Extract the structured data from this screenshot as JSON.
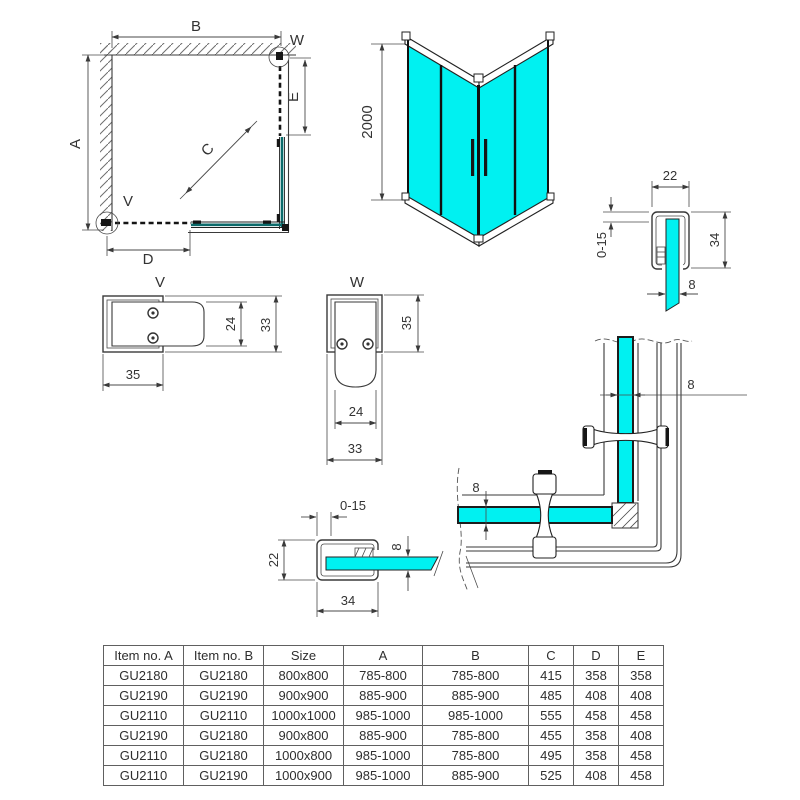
{
  "colors": {
    "glass": "#00f1f1",
    "glass_dark": "#0b6b6b"
  },
  "plan_view": {
    "dim_a": "A",
    "dim_b": "B",
    "dim_c": "C",
    "dim_d": "D",
    "dim_e": "E",
    "label_v": "V",
    "label_w": "W"
  },
  "iso_view": {
    "height": "2000"
  },
  "top_track_profile": {
    "width": "22",
    "adjust": "0-15",
    "height": "34",
    "glass": "8"
  },
  "profile_v": {
    "label": "V",
    "width": "35",
    "inner": "24",
    "outer": "33"
  },
  "profile_w": {
    "label": "W",
    "height": "35",
    "inner": "24",
    "outer": "33"
  },
  "wall_profile": {
    "adjust": "0-15",
    "height": "22",
    "width": "34",
    "glass": "8"
  },
  "corner_detail": {
    "glass_a": "8",
    "glass_b": "8"
  },
  "table": {
    "headers": [
      "Item no. A",
      "Item no. B",
      "Size",
      "A",
      "B",
      "C",
      "D",
      "E"
    ],
    "rows": [
      [
        "GU2180",
        "GU2180",
        "800x800",
        "785-800",
        "785-800",
        "415",
        "358",
        "358"
      ],
      [
        "GU2190",
        "GU2190",
        "900x900",
        "885-900",
        "885-900",
        "485",
        "408",
        "408"
      ],
      [
        "GU2110",
        "GU2110",
        "1000x1000",
        "985-1000",
        "985-1000",
        "555",
        "458",
        "458"
      ],
      [
        "GU2190",
        "GU2180",
        "900x800",
        "885-900",
        "785-800",
        "455",
        "358",
        "408"
      ],
      [
        "GU2110",
        "GU2180",
        "1000x800",
        "985-1000",
        "785-800",
        "495",
        "358",
        "458"
      ],
      [
        "GU2110",
        "GU2190",
        "1000x900",
        "985-1000",
        "885-900",
        "525",
        "408",
        "458"
      ]
    ]
  }
}
